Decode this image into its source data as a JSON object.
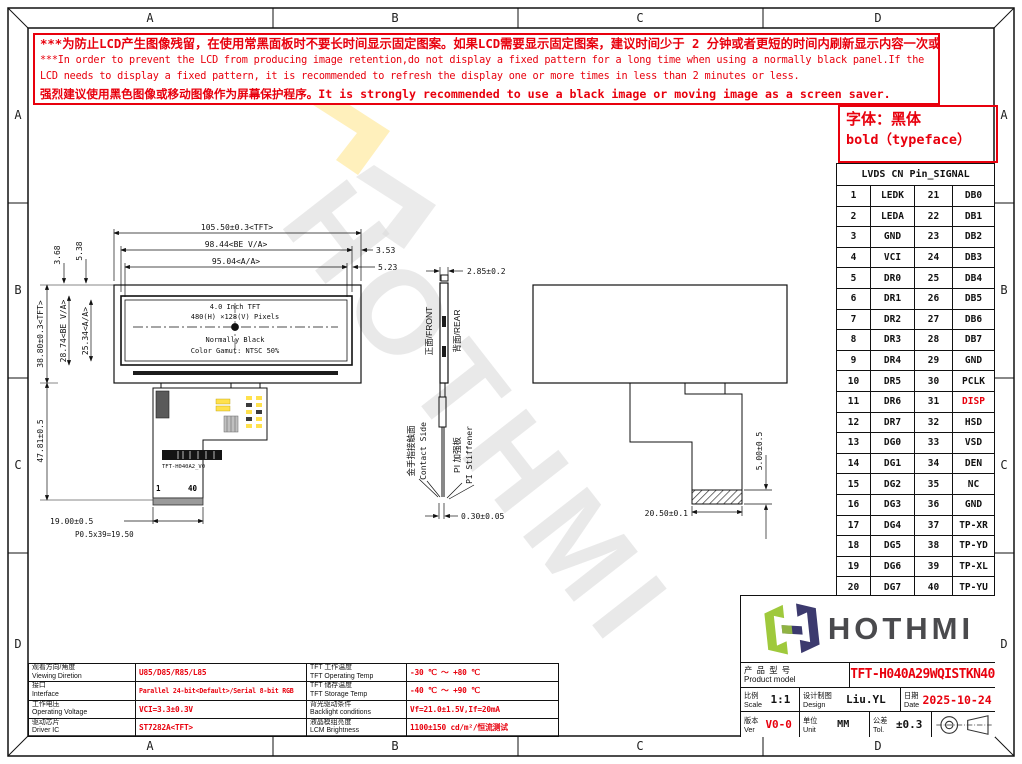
{
  "frame": {
    "cols": [
      "A",
      "B",
      "C",
      "D"
    ],
    "rows": [
      "A",
      "B",
      "C",
      "D"
    ]
  },
  "warning": {
    "line1": "***为防止LCD产生图像残留，在使用常黑面板时不要长时间显示固定图案。如果LCD需要显示固定图案，建议时间少于 2 分钟或者更短的时间内刷新显示内容一次或多次。",
    "line2": "***In order to prevent the LCD from producing image retention,do not display a fixed pattern for a long time when using a normally black panel.If the",
    "line3": " LCD needs to display a fixed pattern, it is recommended to refresh the display one or more times in less than 2 minutes or less.",
    "line4": "强烈建议使用黑色图像或移动图像作为屏幕保护程序。It is strongly recommended to use a black image or moving image as a screen saver."
  },
  "font_note": {
    "line1": "字体：黑体",
    "line2": "bold（typeface）"
  },
  "pin_table": {
    "title": "LVDS CN Pin_SIGNAL",
    "rows": [
      [
        "1",
        "LEDK",
        "21",
        "DB0"
      ],
      [
        "2",
        "LEDA",
        "22",
        "DB1"
      ],
      [
        "3",
        "GND",
        "23",
        "DB2"
      ],
      [
        "4",
        "VCI",
        "24",
        "DB3"
      ],
      [
        "5",
        "DR0",
        "25",
        "DB4"
      ],
      [
        "6",
        "DR1",
        "26",
        "DB5"
      ],
      [
        "7",
        "DR2",
        "27",
        "DB6"
      ],
      [
        "8",
        "DR3",
        "28",
        "DB7"
      ],
      [
        "9",
        "DR4",
        "29",
        "GND"
      ],
      [
        "10",
        "DR5",
        "30",
        "PCLK"
      ],
      [
        "11",
        "DR6",
        "31",
        {
          "t": "DISP",
          "c": "red"
        }
      ],
      [
        "12",
        "DR7",
        "32",
        "HSD"
      ],
      [
        "13",
        "DG0",
        "33",
        "VSD"
      ],
      [
        "14",
        "DG1",
        "34",
        "DEN"
      ],
      [
        "15",
        "DG2",
        "35",
        "NC"
      ],
      [
        "16",
        "DG3",
        "36",
        "GND"
      ],
      [
        "17",
        "DG4",
        "37",
        "TP-XR"
      ],
      [
        "18",
        "DG5",
        "38",
        "TP-YD"
      ],
      [
        "19",
        "DG6",
        "39",
        "TP-XL"
      ],
      [
        "20",
        "DG7",
        "40",
        "TP-YU"
      ]
    ]
  },
  "drawing": {
    "watermark": "HOTHMI",
    "front": {
      "panel": [
        "4.0 Inch TFT",
        "480(H) ×128(V) Pixels",
        "Normally Black",
        "Color Gamut: NTSC 50%"
      ],
      "dim_w_tft": "105.50±0.3<TFT>",
      "dim_w_be": "98.44<BE V/A>",
      "dim_w_aa": "95.04<A/A>",
      "dim_353": "3.53",
      "dim_523": "5.23",
      "dim_538": "5.38",
      "dim_368": "3.68",
      "dim_h_tft": "38.80±0.3<TFT>",
      "dim_h_be": "28.74<BE V/A>",
      "dim_h_aa": "25.34<A/A>",
      "dim_fpc": "47.81±0.5",
      "dim_conn": "19.00±0.5",
      "dim_pitch": "P0.5x39=19.50",
      "pin1": "1",
      "pin40": "40",
      "fpc_label": "TFT-H040A2_V0"
    },
    "side": {
      "dim_top": "2.85±0.2",
      "front": "正面/FRONT",
      "rear": "背面/REAR",
      "contact_cn": "金手指接触面",
      "contact_en": "Contact Side",
      "pi_cn": "PI 加强板",
      "pi_en": "PI Stiffener",
      "dim_bottom": "0.30±0.05"
    },
    "rear": {
      "dim_h": "5.00±0.5",
      "dim_w": "20.50±0.1"
    }
  },
  "spec_table": {
    "rows": [
      {
        "l1c": "观看方向/角度",
        "l1e": "Viewing Diretion",
        "v1": "U85/D85/R85/L85",
        "l2c": "TFT 工作温度",
        "l2e": "TFT Operating Temp",
        "v2": "-30 ℃ ～ +80 ℃"
      },
      {
        "l1c": "接口",
        "l1e": "Interface",
        "v1": "Parallel 24-bit<Default>/Serial 8-bit RGB",
        "l2c": "TFT 储存温度",
        "l2e": "TFT Storage Temp",
        "v2": "-40 ℃ ～ +90 ℃"
      },
      {
        "l1c": "工作电压",
        "l1e": "Operating Voltage",
        "v1": "VCI=3.3±0.3V",
        "l2c": "背光驱动条件",
        "l2e": "Backlight conditions",
        "v2": "Vf=21.0±1.5V,If=20mA"
      },
      {
        "l1c": "驱动芯片",
        "l1e": "Driver IC",
        "v1": "ST7282A<TFT>",
        "l2c": "液晶模组亮度",
        "l2e": "LCM Brightness",
        "v2": "1100±150 cd/m²/恒流测试"
      }
    ]
  },
  "title_block": {
    "logo_text": "HOTHMI",
    "product_label_cn": "产 品 型 号",
    "product_label_en": "Product model",
    "product_value": "TFT-H040A29WQISTKN40",
    "scale_cn": "比例",
    "scale_en": "Scale",
    "scale_value": "1:1",
    "design_cn": "设计制图",
    "design_en": "Design",
    "design_value": "Liu.YL",
    "date_cn": "日期",
    "date_en": "Date",
    "date_value": "2025-10-24",
    "ver_cn": "版本",
    "ver_en": "Ver",
    "ver_value": "V0-0",
    "unit_cn": "单位",
    "unit_en": "Unit",
    "unit_value": "MM",
    "tol_cn": "公差",
    "tol_en": "Tol.",
    "tol_value": "±0.3"
  },
  "colors": {
    "accent_red": "#e8000d",
    "logo_green": "#9fc93c",
    "logo_navy": "#3c3a6e"
  }
}
